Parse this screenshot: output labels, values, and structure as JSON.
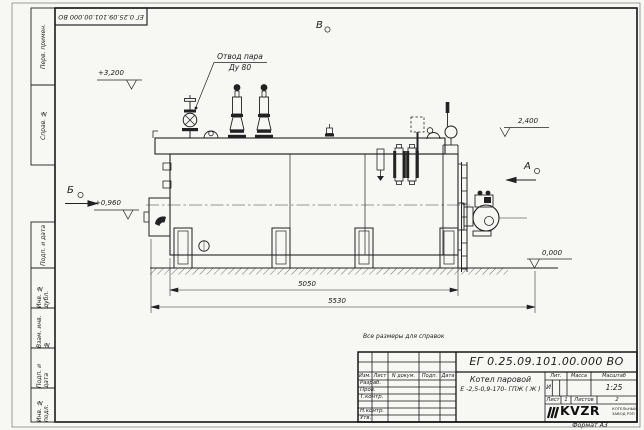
{
  "frame": {
    "doc_number_top": "ЕГ 0.25.09.101.00.000  ВО",
    "format_label": "Формат  А3",
    "margin_top_cells": [
      "Перв. примен.",
      "Справ. №"
    ],
    "margin_bottom_cells": [
      "Подп. и дата",
      "Инв. № дубл.",
      "Взам. инв. №",
      "Подп. и дата",
      "Инв. № подл."
    ]
  },
  "note": "Все размеры для справок",
  "title_block": {
    "doc_number": "ЕГ 0.25.09.101.00.000  ВО",
    "product_name": "Котел паровой",
    "product_model": "Е -2,5-0,9-170- ГПЖ ( Ж )",
    "col_izm": "Изм.",
    "col_list": "Лист",
    "col_ndokum": "N докум.",
    "col_podp": "Подп.",
    "col_data": "Дата",
    "row_razrab": "Разраб.",
    "row_prov": "Пров.",
    "row_tkontr": "Т.контр.",
    "row_nkontr": "Н.контр.",
    "row_utv": "Утв.",
    "hdr_lit": "Лит.",
    "hdr_massa": "Масса",
    "hdr_masshtab": "Масштаб",
    "lit_value": "И",
    "scale": "1:25",
    "lbl_list": "Лист",
    "val_list": "1",
    "lbl_listov": "Листов",
    "val_listov": "2",
    "logo": "KVZR",
    "logo_sub1": "КОТЕЛЬНЫЙ",
    "logo_sub2": "ЗАВОД РЭП"
  },
  "drawing": {
    "label_steam1": "Отвод пара",
    "label_steam2": "Ду 80",
    "elev_top": "+3,200",
    "elev_right_top": "2,400",
    "elev_left": "+0,960",
    "elev_zero": "0,000",
    "view_a": "А",
    "view_b": "Б",
    "view_v": "В",
    "dim_inner": "5050",
    "dim_outer": "5530"
  }
}
